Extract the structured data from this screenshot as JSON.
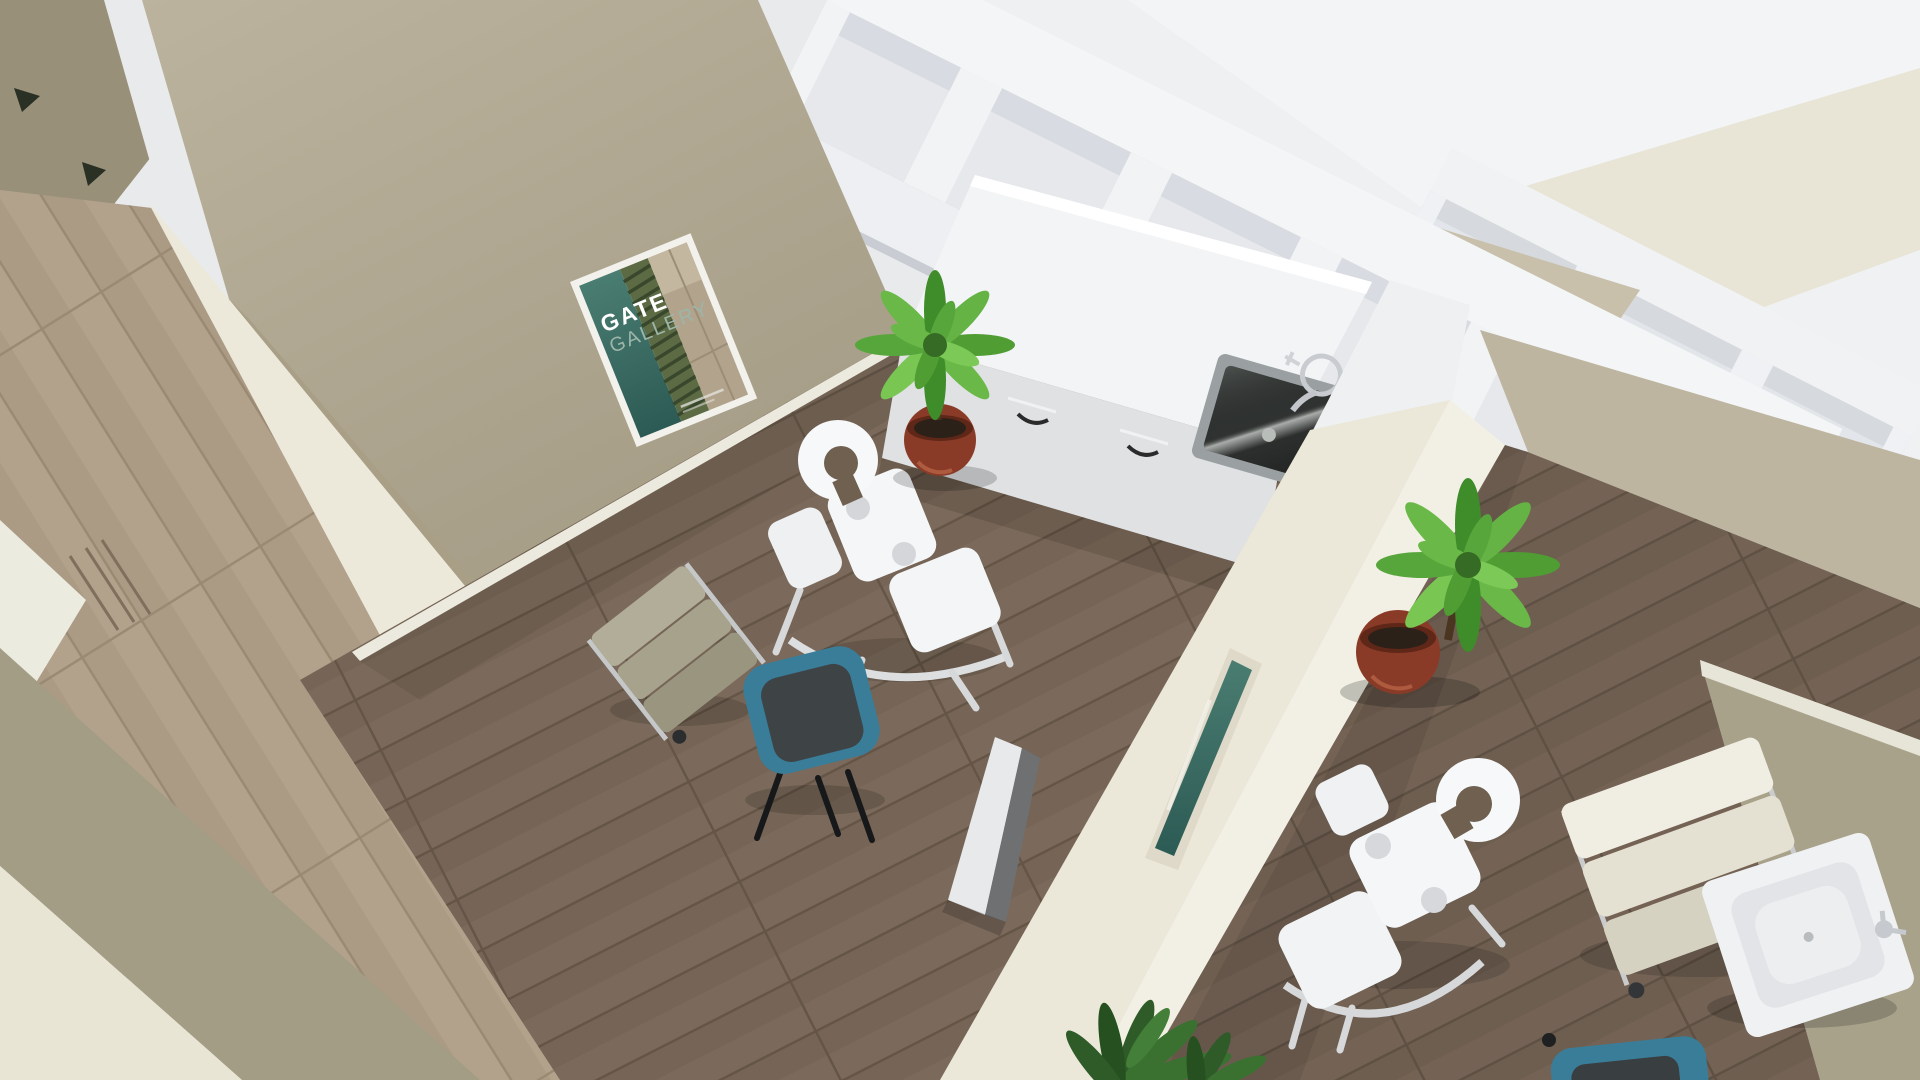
{
  "scene": {
    "title": "Overhead 3D render of spa massage rooms",
    "poster": {
      "line1": "GATE",
      "line2": "GALLERY"
    },
    "rooms": [
      "hallway",
      "massage-room-left",
      "massage-room-right"
    ],
    "objects": [
      "gallery-poster",
      "massage-chair-left",
      "massage-chair-right",
      "guest-chair-teal-left",
      "guest-chair-teal-right",
      "tray-cart-left",
      "tray-cart-right",
      "potted-plant-counter",
      "potted-plant-right",
      "potted-plant-bottom",
      "cabinet-counter",
      "counter-sink",
      "wash-basin",
      "leaning-white-panel",
      "leaning-teal-picture",
      "clerestory-beam-frame",
      "hallway-door"
    ],
    "palette": {
      "wall_tan": "#b5ad96",
      "wall_cream": "#ece9da",
      "beam_white": "#f2f3f5",
      "ceiling": "#eff0f2",
      "floor_room": "#7b6a5b",
      "floor_hall": "#b2a28c",
      "chair_teal": "#3a7d99",
      "seat_charcoal": "#3e4346",
      "plant_green": "#5aa83e",
      "pot_terracotta": "#8a3b28",
      "sink_steel": "#2f3230"
    }
  }
}
